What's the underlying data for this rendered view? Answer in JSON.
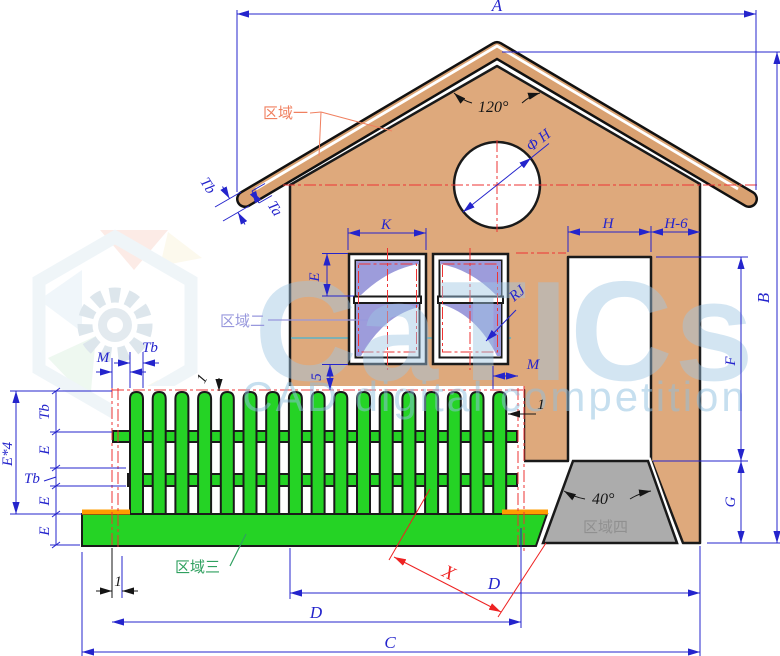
{
  "drawing": {
    "dims": {
      "A": "A",
      "B": "B",
      "C": "C",
      "D": "D",
      "E": "E",
      "E4": "E*4",
      "F": "F",
      "G": "G",
      "H": "H",
      "H6": "H-6",
      "K": "K",
      "M": "M",
      "Tb": "Tb",
      "Ta": "Ta",
      "X": "X",
      "RJ": "RJ",
      "phiH": "Φ H",
      "angleRoof": "120°",
      "angleStep": "40°",
      "five": "5",
      "one": "1"
    },
    "regions": {
      "r1": "区域一",
      "r2": "区域二",
      "r3": "区域三",
      "r4": "区域四"
    },
    "watermark": {
      "brand": "CaTICs",
      "subtitle": "CAD digital competition"
    },
    "colors": {
      "wall": "#dea97c",
      "roof": "#d9a171",
      "fence": "#25d325",
      "step": "#acacac",
      "pane": "#9d9cdb",
      "dimension": "#2424cc",
      "centerline": "#ee3333",
      "highlight": "#ff9c00"
    }
  }
}
